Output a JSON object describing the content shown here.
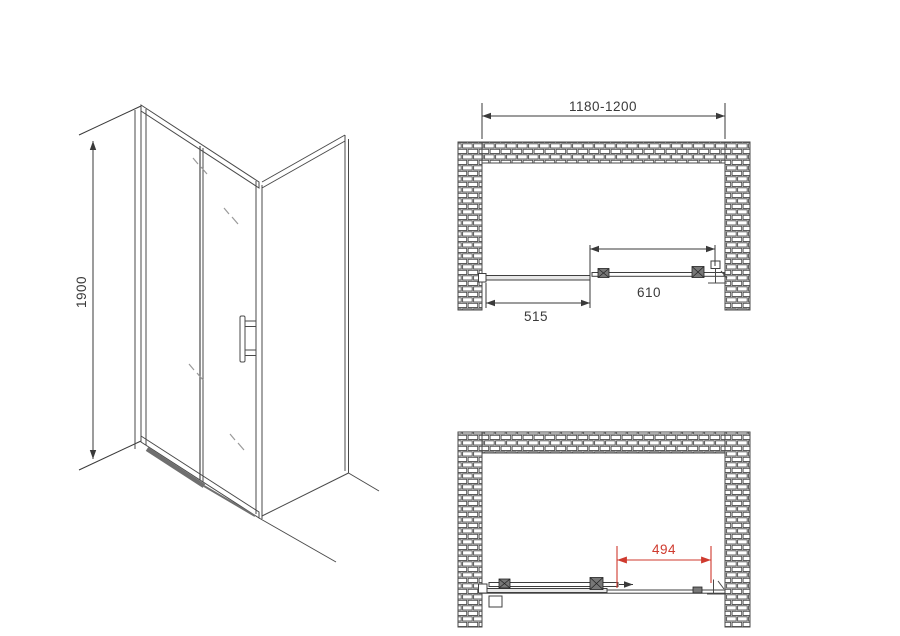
{
  "drawing": {
    "elevation": {
      "height_label": "1900"
    },
    "plan_closed": {
      "opening_width_label": "1180-1200",
      "door_panel_label": "610",
      "fixed_panel_label": "515"
    },
    "plan_open": {
      "clear_passage_label": "494"
    }
  },
  "colors": {
    "line": "#4a4a4a",
    "dimension": "#3a3a3a",
    "accent_red": "#cf3a2e",
    "background": "#ffffff"
  }
}
